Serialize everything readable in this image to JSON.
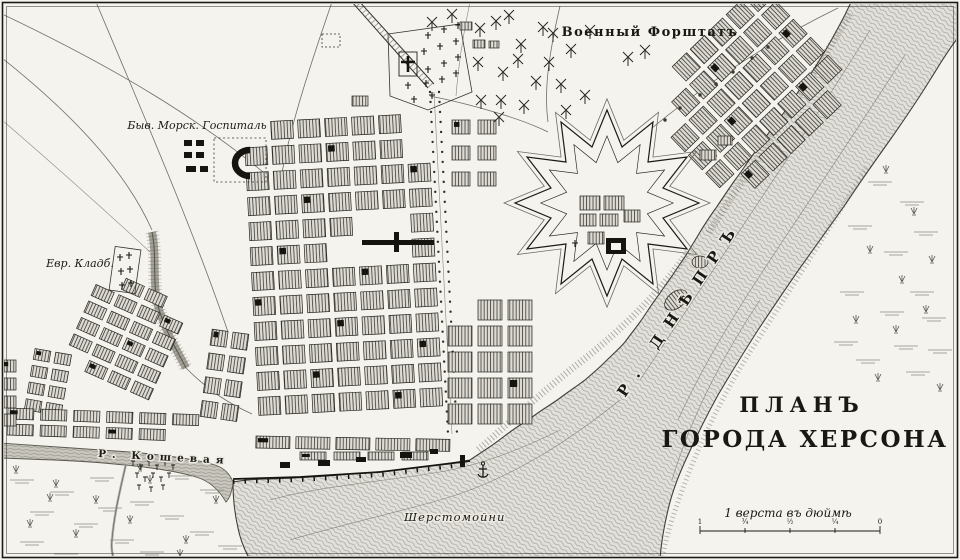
{
  "map": {
    "title": {
      "line1": "ПЛАНЪ",
      "line2": "ГОРОДА ХЕРСОНА"
    },
    "labels": {
      "military_suburb": "Военный Форштатъ",
      "naval_hospital": "Быв. Морск. Госпиталь",
      "jewish_cemetery": "Евр. Кладб.",
      "dnieper_river": "Р. ДНѢПРЪ",
      "koshevaya_river": "Р. Кошевая",
      "wool_washery": "Шерстомойни"
    },
    "scale": {
      "label": "1 верста въ дюймѣ",
      "ticks": [
        "1",
        "¾",
        "½",
        "¼",
        "0"
      ]
    },
    "colors": {
      "paper": "#f4f3ee",
      "ink": "#1b1a14",
      "water_fill": "#e1dfd9",
      "water_line": "#a6a49c",
      "koshevaya_fill": "#ccc9c1"
    }
  }
}
